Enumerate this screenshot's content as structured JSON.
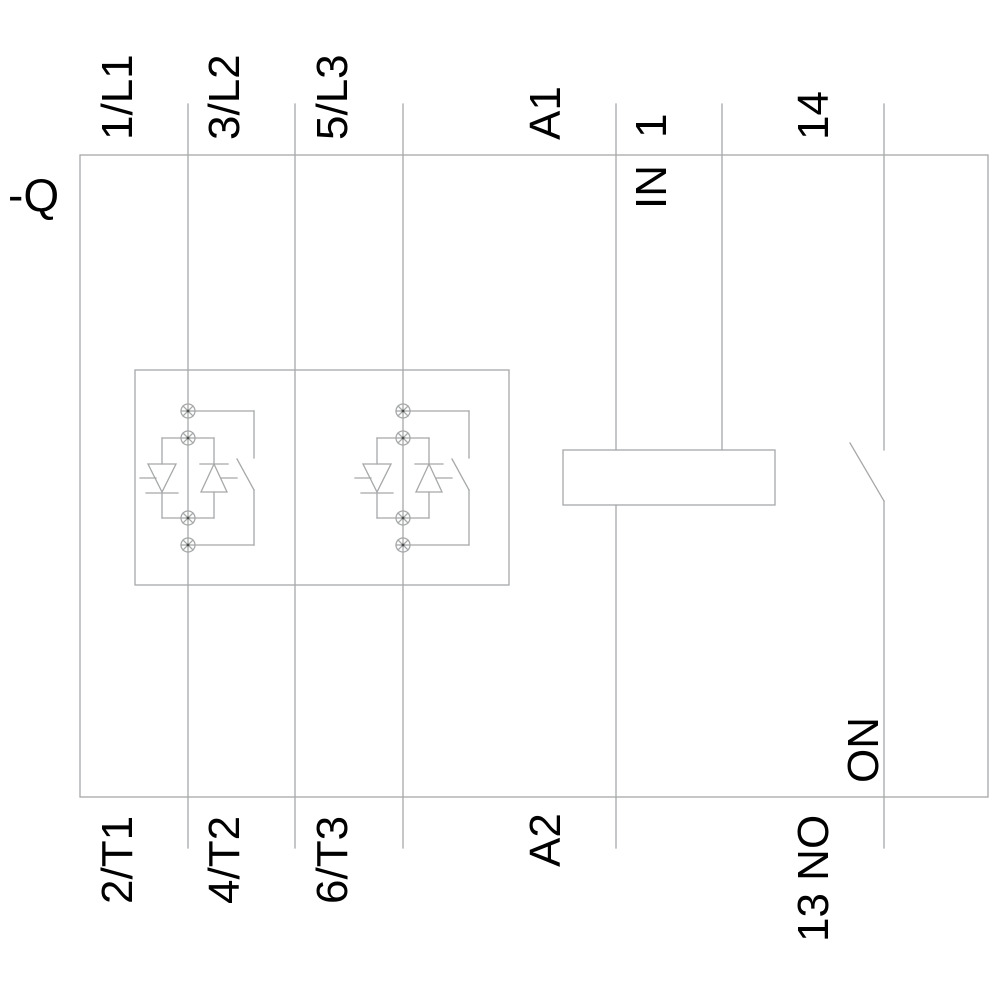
{
  "schematic": {
    "device_designation": "-Q",
    "terminals": {
      "top": {
        "l1": "1/L1",
        "l2": "3/L2",
        "l3": "5/L3",
        "a1": "A1",
        "input": "1",
        "no14": "14"
      },
      "bottom": {
        "t1": "2/T1",
        "t2": "4/T2",
        "t3": "6/T3",
        "a2": "A2",
        "no13": "13 NO"
      }
    },
    "internal_labels": {
      "input_function": "IN",
      "on_function": "ON"
    },
    "colors": {
      "line": "#a6a8a9",
      "text": "#000000",
      "background": "#ffffff"
    }
  }
}
